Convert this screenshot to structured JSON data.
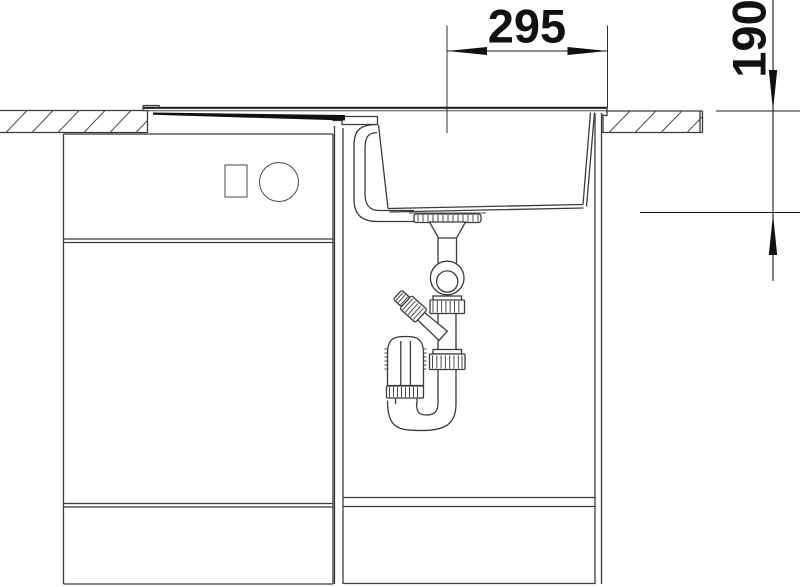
{
  "drawing": {
    "title": "sink-installation-side-view",
    "background_color": "#ffffff",
    "line_color": "#3b3b3b",
    "accent_color": "#111111"
  },
  "dimensions": {
    "horizontal": {
      "value": "295",
      "orientation": "horizontal"
    },
    "vertical": {
      "value": "190",
      "orientation": "vertical"
    }
  },
  "components": [
    "countertop-left-section",
    "countertop-right-section",
    "sink-rim",
    "drainboard",
    "overflow-housing",
    "overflow-channel",
    "sink-basin",
    "drain-flange",
    "drain-tailpipe",
    "ball-joint",
    "union-nut",
    "dishwasher-connector",
    "trap-cup",
    "trap-u-bend",
    "cabinet-left",
    "cabinet-sink",
    "plinth",
    "appliance-marker-rect",
    "appliance-marker-circle",
    "dimension-295",
    "dimension-190"
  ]
}
